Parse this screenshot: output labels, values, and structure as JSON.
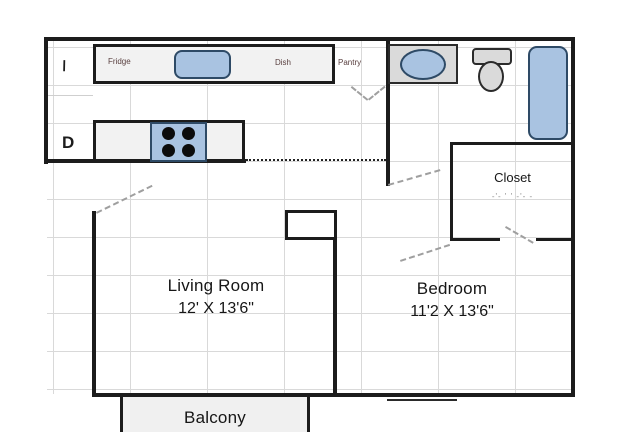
{
  "colors": {
    "wall": "#1c1c1c",
    "grid_line": "#d9d9d9",
    "counter_fill": "#f2f2f2",
    "fixture_gray": "#dadada",
    "fixture_blue": "#a9c3e1",
    "balcony_fill": "#f0f0f0",
    "kitchen_label_text": "#5a4040",
    "door_swing_dash": "#9f9f9f"
  },
  "kitchen": {
    "fridge_label": "Fridge",
    "dish_label": "Dish",
    "pantry_label": "Pantry"
  },
  "laundry": {
    "washer_mark": "\\",
    "dryer_mark": "D"
  },
  "rooms": {
    "living_room": {
      "name": "Living Room",
      "dimensions": "12' X 13'6\""
    },
    "bedroom": {
      "name": "Bedroom",
      "dimensions": "11'2 X 13'6\""
    },
    "closet": {
      "name": "Closet",
      "dimensions_obscured": "-'-  ' '  -'- -"
    },
    "balcony": {
      "name": "Balcony"
    }
  },
  "fixtures": {
    "kitchen_sink": "sink",
    "stove": "stove-4-burners",
    "bathroom_sink": "vanity-sink",
    "toilet": "toilet",
    "bathtub": "bathtub"
  }
}
